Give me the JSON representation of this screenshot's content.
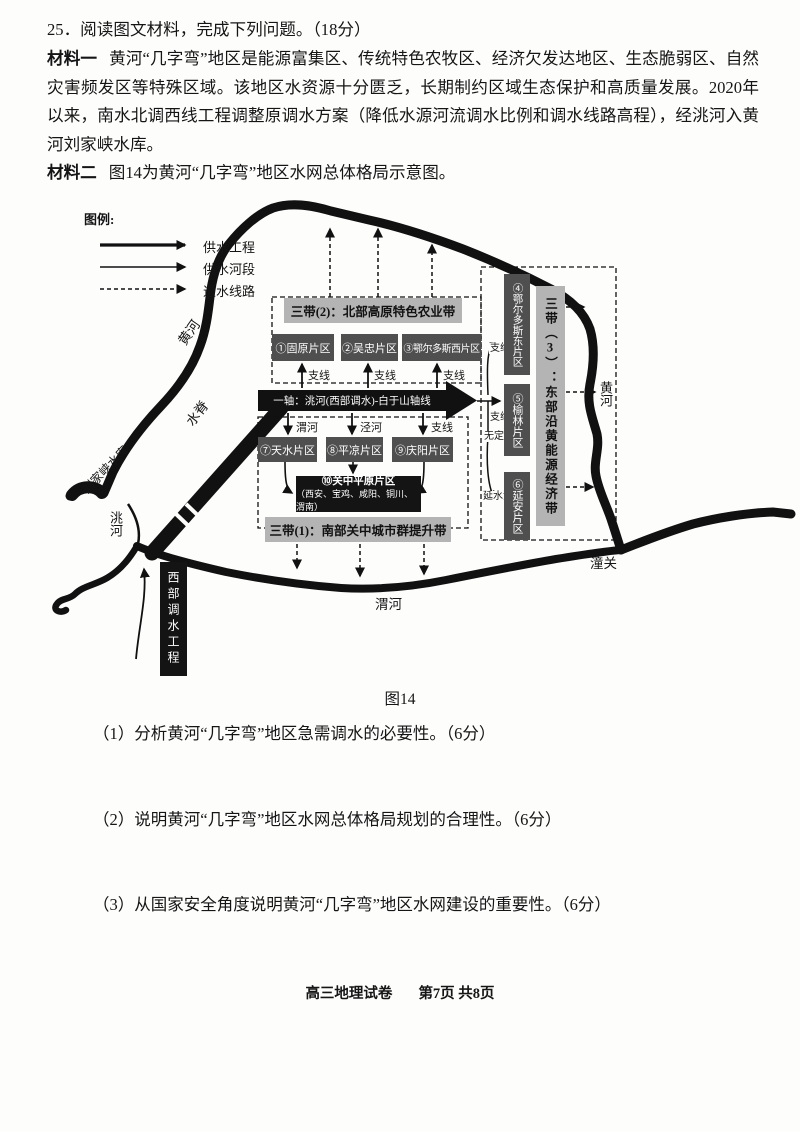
{
  "page": {
    "title_line": "25．阅读图文材料，完成下列问题。（18分）",
    "materials": [
      {
        "label": "材料一",
        "text": "黄河“几字弯”地区是能源富集区、传统特色农牧区、经济欠发达地区、生态脆弱区、自然灾害频发区等特殊区域。该地区水资源十分匮乏，长期制约区域生态保护和高质量发展。2020年以来，南水北调西线工程调整原调水方案（降低水源河流调水比例和调水线路高程），经洮河入黄河刘家峡水库。"
      },
      {
        "label": "材料二",
        "text": "图14为黄河“几字弯”地区水网总体格局示意图。"
      }
    ],
    "questions": [
      "（1）分析黄河“几字弯”地区急需调水的必要性。（6分）",
      "（2）说明黄河“几字弯”地区水网总体格局规划的合理性。（6分）",
      "（3）从国家安全角度说明黄河“几字弯”地区水网建设的重要性。（6分）"
    ],
    "footer": {
      "exam": "高三地理试卷",
      "page": "第7页 共8页"
    }
  },
  "figure": {
    "caption": "图14",
    "legend": {
      "title": "图例:",
      "items": [
        {
          "label": "供水工程",
          "style": "thick-solid-arrow"
        },
        {
          "label": "供水河段",
          "style": "thin-solid-arrow"
        },
        {
          "label": "退水线路",
          "style": "dashed-arrow"
        }
      ]
    },
    "axis": "一轴：洮河(西部调水)-白于山轴线",
    "belts": {
      "belt1": "三带(1)：南部关中城市群提升带",
      "belt2": "三带(2)：北部高原特色农业带",
      "belt3": "三带（3）：东部沿黄能源经济带"
    },
    "zones": {
      "z1": "①固原片区",
      "z2": "②吴忠片区",
      "z3": "③鄂尔多斯西片区",
      "z4": "④鄂尔多斯东片区",
      "z5": "⑤榆林片区",
      "z6": "⑥延安片区",
      "z7": "⑦天水片区",
      "z8": "⑧平凉片区",
      "z9": "⑨庆阳片区",
      "z10_title": "⑩关中平原片区",
      "z10_cities": "（西安、宝鸡、咸阳、铜川、渭南）"
    },
    "labels": {
      "huanghe": "黄河",
      "weihe": "渭河",
      "jinghe": "泾河",
      "taohe": "洮河",
      "zhixian": "支线",
      "wudinghe": "无定河",
      "yanshuihe": "延水河",
      "liujiaxia": "刘家峡水库",
      "shuiji": "水脊",
      "tongguan": "潼关",
      "xibu_project": "西部调水工程"
    },
    "colors": {
      "band_gray": "#b4b4b4",
      "zone_dark": "#4f4f4f",
      "box_black": "#141414"
    }
  }
}
